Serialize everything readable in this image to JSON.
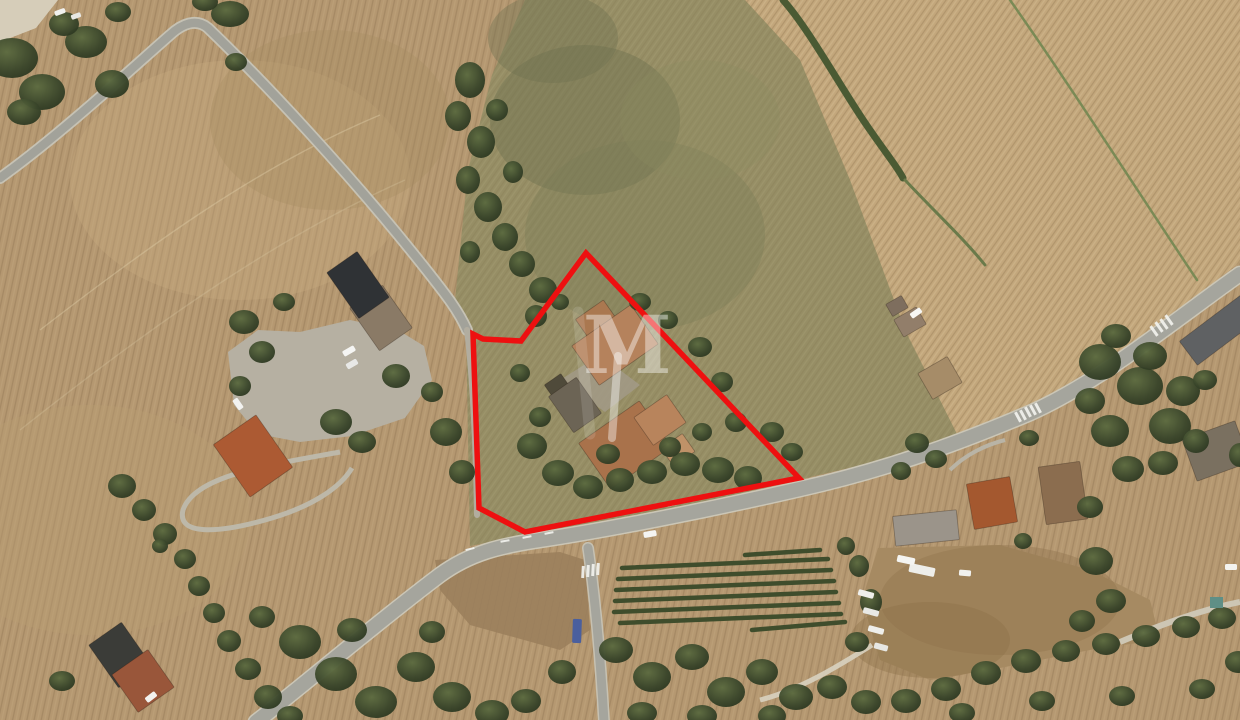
{
  "image": {
    "kind": "aerial-satellite-photograph",
    "description": "Top-down satellite view of a rural farm property outlined with a red boundary polygon, surrounded by plowed tan fields, roads, tree clusters, houses and a small vineyard block",
    "width_px": 1240,
    "height_px": 720
  },
  "watermark": {
    "letter": "M",
    "color": "#ffffff",
    "opacity": 0.42
  },
  "boundary": {
    "color": "#ee1010",
    "stroke_width": 5.5,
    "points": "586,253 521,341 483,339 473,334 479,508 525,532 799,478"
  },
  "palette": {
    "field_tan": "#b59871",
    "field_plowed_light": "#c3a77c",
    "field_olive": "#968e65",
    "dirt_brown": "#a68a62",
    "road_asphalt": "#a5a59d",
    "road_casing": "#c9c4b4",
    "gravel": "#b6b0a2",
    "tree_dark": "#39452a",
    "roof_terracotta": "#a9724b",
    "roof_dark": "#33363a",
    "roof_grey": "#9b948a",
    "boundary_red": "#ee1010"
  },
  "scene": {
    "fields": [
      {
        "name": "plowed-field-top-left",
        "color": "#b59871"
      },
      {
        "name": "plowed-field-top-right",
        "color": "#c3a77c"
      },
      {
        "name": "rough-pasture-center",
        "color": "#968e65"
      },
      {
        "name": "dirt-lot-bottom-right",
        "color": "#a68a62"
      },
      {
        "name": "dirt-patch-bottom-center",
        "color": "#9b7f5c"
      }
    ],
    "roads": [
      {
        "name": "country-road-top-left"
      },
      {
        "name": "main-road-bottom"
      },
      {
        "name": "side-road-south"
      },
      {
        "name": "west-boundary-track"
      },
      {
        "name": "chapel-driveway-loop"
      },
      {
        "name": "gravel-parking-area"
      }
    ],
    "vineyard_rows": [
      [
        745,
        555,
        820,
        550
      ],
      [
        622,
        568,
        828,
        559
      ],
      [
        618,
        579,
        831,
        570
      ],
      [
        616,
        590,
        834,
        581
      ],
      [
        615,
        601,
        836,
        592
      ],
      [
        614,
        612,
        839,
        603
      ],
      [
        620,
        623,
        841,
        614
      ],
      [
        752,
        630,
        845,
        622
      ]
    ],
    "buildings": [
      {
        "name": "barn-lower-grey",
        "cx": 381,
        "cy": 318,
        "w": 40,
        "h": 52,
        "rot": -35,
        "color": "#8a7a66"
      },
      {
        "name": "barn-dark-roof",
        "cx": 358,
        "cy": 285,
        "w": 37,
        "h": 56,
        "rot": -35,
        "color": "#2f3235"
      },
      {
        "name": "red-roof-chapel",
        "cx": 253,
        "cy": 456,
        "w": 52,
        "h": 64,
        "rot": -35,
        "color": "#ac5a33"
      },
      {
        "name": "farmhouse-upper-wing",
        "cx": 598,
        "cy": 322,
        "w": 34,
        "h": 30,
        "rot": -35,
        "color": "#aa7850"
      },
      {
        "name": "farmhouse-upper",
        "cx": 615,
        "cy": 345,
        "w": 72,
        "h": 48,
        "rot": -35,
        "color": "#b5825c"
      },
      {
        "name": "farm-shed-dark",
        "cx": 560,
        "cy": 390,
        "w": 20,
        "h": 26,
        "rot": -35,
        "color": "#4f4a3a"
      },
      {
        "name": "farm-shed-left",
        "cx": 575,
        "cy": 405,
        "w": 34,
        "h": 44,
        "rot": -35,
        "color": "#6c6455"
      },
      {
        "name": "farmhouse-lower",
        "cx": 625,
        "cy": 445,
        "w": 74,
        "h": 56,
        "rot": -35,
        "color": "#a9724b"
      },
      {
        "name": "farmhouse-east-wing",
        "cx": 660,
        "cy": 420,
        "w": 40,
        "h": 34,
        "rot": -35,
        "color": "#b8845c"
      },
      {
        "name": "farm-annex-small",
        "cx": 678,
        "cy": 450,
        "w": 26,
        "h": 22,
        "rot": -35,
        "color": "#bf9268"
      },
      {
        "name": "house-tan-north",
        "cx": 940,
        "cy": 378,
        "w": 34,
        "h": 30,
        "rot": -30,
        "color": "#a68c68"
      },
      {
        "name": "shed-north-small",
        "cx": 910,
        "cy": 322,
        "w": 26,
        "h": 20,
        "rot": -30,
        "color": "#927e6a"
      },
      {
        "name": "shed-north-tiny",
        "cx": 897,
        "cy": 306,
        "w": 18,
        "h": 14,
        "rot": -30,
        "color": "#7e6e5e"
      },
      {
        "name": "house-red-southeast",
        "cx": 992,
        "cy": 503,
        "w": 44,
        "h": 46,
        "rot": -10,
        "color": "#a4582f"
      },
      {
        "name": "house-brown-southeast",
        "cx": 1063,
        "cy": 493,
        "w": 42,
        "h": 58,
        "rot": -8,
        "color": "#8b6d4f"
      },
      {
        "name": "house-grey-south",
        "cx": 926,
        "cy": 528,
        "w": 64,
        "h": 30,
        "rot": -6,
        "color": "#9b948a"
      },
      {
        "name": "building-grey-right-top",
        "cx": 1222,
        "cy": 328,
        "w": 84,
        "h": 30,
        "rot": -37,
        "color": "#5f6163"
      },
      {
        "name": "building-grey-right-mid",
        "cx": 1216,
        "cy": 451,
        "w": 56,
        "h": 44,
        "rot": -20,
        "color": "#7a7060"
      },
      {
        "name": "house-dark-bottom-left",
        "cx": 120,
        "cy": 655,
        "w": 40,
        "h": 52,
        "rot": -35,
        "color": "#3b3c38"
      },
      {
        "name": "house-red-bottom-left",
        "cx": 143,
        "cy": 681,
        "w": 44,
        "h": 46,
        "rot": -35,
        "color": "#99563a"
      }
    ],
    "vehicles": [
      [
        349,
        351,
        13,
        6,
        -30,
        "#f5f5f3"
      ],
      [
        352,
        364,
        12,
        6,
        -30,
        "#e8e8e6"
      ],
      [
        238,
        404,
        12,
        6,
        55,
        "#f2f2f0"
      ],
      [
        916,
        313,
        12,
        6,
        -35,
        "#f7f7f5"
      ],
      [
        650,
        534,
        13,
        6,
        -10,
        "#f4f4f2"
      ],
      [
        577,
        631,
        9,
        24,
        2,
        "#4a5f9e"
      ],
      [
        151,
        697,
        12,
        6,
        -38,
        "#f2f2ef"
      ],
      [
        922,
        570,
        26,
        9,
        12,
        "#eeeeea"
      ],
      [
        906,
        560,
        18,
        7,
        12,
        "#f4f4f1"
      ],
      [
        965,
        573,
        12,
        6,
        5,
        "#f1f1ee"
      ],
      [
        866,
        594,
        16,
        6,
        15,
        "#efefec"
      ],
      [
        871,
        612,
        16,
        6,
        15,
        "#e9e9e5"
      ],
      [
        876,
        630,
        16,
        6,
        15,
        "#efefeb"
      ],
      [
        881,
        647,
        14,
        6,
        15,
        "#e7e7e3"
      ],
      [
        1231,
        567,
        12,
        6,
        0,
        "#f3f3f0"
      ],
      [
        60,
        12,
        11,
        5,
        -20,
        "#f1f1ee"
      ],
      [
        76,
        16,
        10,
        5,
        -20,
        "#e8e8e4"
      ]
    ],
    "road_markings": [
      [
        583,
        572,
        3,
        12,
        3
      ],
      [
        588,
        571,
        3,
        12,
        3
      ],
      [
        593,
        570,
        3,
        12,
        3
      ],
      [
        598,
        569,
        3,
        12,
        3
      ],
      [
        1154,
        331,
        3,
        12,
        -35
      ],
      [
        1159,
        327,
        3,
        12,
        -35
      ],
      [
        1164,
        324,
        3,
        12,
        -35
      ],
      [
        1169,
        320,
        3,
        12,
        -35
      ],
      [
        1018,
        417,
        3,
        11,
        -28
      ],
      [
        1023,
        415,
        3,
        11,
        -28
      ],
      [
        1028,
        412,
        3,
        11,
        -28
      ],
      [
        1033,
        410,
        3,
        11,
        -28
      ],
      [
        1038,
        408,
        3,
        11,
        -28
      ],
      [
        505,
        541,
        9,
        2,
        -10
      ],
      [
        527,
        537,
        9,
        2,
        -11
      ],
      [
        549,
        533,
        9,
        2,
        -11
      ],
      [
        470,
        549,
        9,
        2,
        -14
      ],
      [
        672,
        505,
        9,
        2,
        -12
      ],
      [
        700,
        499,
        9,
        2,
        -12
      ]
    ],
    "trees": [
      [
        12,
        58,
        26,
        20
      ],
      [
        42,
        92,
        23,
        18
      ],
      [
        86,
        42,
        21,
        16
      ],
      [
        112,
        84,
        17,
        14
      ],
      [
        24,
        112,
        17,
        13
      ],
      [
        64,
        24,
        15,
        12
      ],
      [
        118,
        12,
        13,
        10
      ],
      [
        230,
        14,
        19,
        13
      ],
      [
        205,
        2,
        13,
        9
      ],
      [
        236,
        62,
        11,
        9
      ],
      [
        470,
        80,
        15,
        18
      ],
      [
        458,
        116,
        13,
        15
      ],
      [
        481,
        142,
        14,
        16
      ],
      [
        468,
        180,
        12,
        14
      ],
      [
        488,
        207,
        14,
        15
      ],
      [
        505,
        237,
        13,
        14
      ],
      [
        522,
        264,
        13,
        13
      ],
      [
        543,
        290,
        14,
        13
      ],
      [
        497,
        110,
        11,
        11
      ],
      [
        513,
        172,
        10,
        11
      ],
      [
        536,
        316,
        11,
        11
      ],
      [
        470,
        252,
        10,
        11
      ],
      [
        244,
        322,
        15,
        12
      ],
      [
        262,
        352,
        13,
        11
      ],
      [
        240,
        386,
        11,
        10
      ],
      [
        284,
        302,
        11,
        9
      ],
      [
        336,
        422,
        16,
        13
      ],
      [
        362,
        442,
        14,
        11
      ],
      [
        396,
        376,
        14,
        12
      ],
      [
        446,
        432,
        16,
        14
      ],
      [
        462,
        472,
        13,
        12
      ],
      [
        432,
        392,
        11,
        10
      ],
      [
        122,
        486,
        14,
        12
      ],
      [
        144,
        510,
        12,
        11
      ],
      [
        165,
        534,
        12,
        11
      ],
      [
        185,
        559,
        11,
        10
      ],
      [
        199,
        586,
        11,
        10
      ],
      [
        214,
        613,
        11,
        10
      ],
      [
        229,
        641,
        12,
        11
      ],
      [
        248,
        669,
        13,
        11
      ],
      [
        268,
        697,
        14,
        12
      ],
      [
        290,
        716,
        13,
        10
      ],
      [
        62,
        681,
        13,
        10
      ],
      [
        160,
        546,
        8,
        7
      ],
      [
        532,
        446,
        15,
        13
      ],
      [
        558,
        473,
        16,
        13
      ],
      [
        588,
        487,
        15,
        12
      ],
      [
        620,
        480,
        14,
        12
      ],
      [
        652,
        472,
        15,
        12
      ],
      [
        685,
        464,
        15,
        12
      ],
      [
        718,
        470,
        16,
        13
      ],
      [
        748,
        478,
        14,
        12
      ],
      [
        608,
        454,
        12,
        10
      ],
      [
        670,
        447,
        11,
        10
      ],
      [
        702,
        432,
        10,
        9
      ],
      [
        540,
        417,
        11,
        10
      ],
      [
        520,
        373,
        10,
        9
      ],
      [
        640,
        302,
        11,
        9
      ],
      [
        668,
        320,
        10,
        9
      ],
      [
        700,
        347,
        12,
        10
      ],
      [
        722,
        382,
        11,
        10
      ],
      [
        736,
        422,
        11,
        10
      ],
      [
        560,
        302,
        9,
        8
      ],
      [
        772,
        432,
        12,
        10
      ],
      [
        792,
        452,
        11,
        9
      ],
      [
        300,
        642,
        21,
        17
      ],
      [
        336,
        674,
        21,
        17
      ],
      [
        376,
        702,
        21,
        16
      ],
      [
        416,
        667,
        19,
        15
      ],
      [
        452,
        697,
        19,
        15
      ],
      [
        492,
        713,
        17,
        13
      ],
      [
        352,
        630,
        15,
        12
      ],
      [
        262,
        617,
        13,
        11
      ],
      [
        526,
        701,
        15,
        12
      ],
      [
        562,
        672,
        14,
        12
      ],
      [
        432,
        632,
        13,
        11
      ],
      [
        616,
        650,
        17,
        13
      ],
      [
        652,
        677,
        19,
        15
      ],
      [
        692,
        657,
        17,
        13
      ],
      [
        726,
        692,
        19,
        15
      ],
      [
        762,
        672,
        16,
        13
      ],
      [
        796,
        697,
        17,
        13
      ],
      [
        832,
        687,
        15,
        12
      ],
      [
        866,
        702,
        15,
        12
      ],
      [
        642,
        713,
        15,
        11
      ],
      [
        702,
        716,
        15,
        11
      ],
      [
        772,
        716,
        14,
        11
      ],
      [
        857,
        642,
        12,
        10
      ],
      [
        871,
        602,
        11,
        13
      ],
      [
        859,
        566,
        10,
        11
      ],
      [
        846,
        546,
        9,
        9
      ],
      [
        906,
        701,
        15,
        12
      ],
      [
        946,
        689,
        15,
        12
      ],
      [
        986,
        673,
        15,
        12
      ],
      [
        1026,
        661,
        15,
        12
      ],
      [
        1066,
        651,
        14,
        11
      ],
      [
        1106,
        644,
        14,
        11
      ],
      [
        1146,
        636,
        14,
        11
      ],
      [
        1186,
        627,
        14,
        11
      ],
      [
        1222,
        618,
        14,
        11
      ],
      [
        962,
        713,
        13,
        10
      ],
      [
        1042,
        701,
        13,
        10
      ],
      [
        1122,
        696,
        13,
        10
      ],
      [
        1202,
        689,
        13,
        10
      ],
      [
        1238,
        662,
        13,
        11
      ],
      [
        1100,
        362,
        21,
        18
      ],
      [
        1140,
        386,
        23,
        19
      ],
      [
        1170,
        426,
        21,
        18
      ],
      [
        1110,
        431,
        19,
        16
      ],
      [
        1150,
        356,
        17,
        14
      ],
      [
        1183,
        391,
        17,
        15
      ],
      [
        1128,
        469,
        16,
        13
      ],
      [
        1163,
        463,
        15,
        12
      ],
      [
        1196,
        441,
        13,
        12
      ],
      [
        1090,
        401,
        15,
        13
      ],
      [
        1116,
        336,
        15,
        12
      ],
      [
        917,
        443,
        12,
        10
      ],
      [
        936,
        459,
        11,
        9
      ],
      [
        901,
        471,
        10,
        9
      ],
      [
        1029,
        438,
        10,
        8
      ],
      [
        1096,
        561,
        17,
        14
      ],
      [
        1111,
        601,
        15,
        12
      ],
      [
        1082,
        621,
        13,
        11
      ],
      [
        1090,
        507,
        13,
        11
      ],
      [
        1023,
        541,
        9,
        8
      ],
      [
        1240,
        455,
        11,
        12
      ],
      [
        1205,
        380,
        12,
        10
      ]
    ],
    "pool_square": {
      "x": 1210,
      "y": 597,
      "w": 13,
      "h": 11,
      "color": "#5f8f86"
    }
  }
}
